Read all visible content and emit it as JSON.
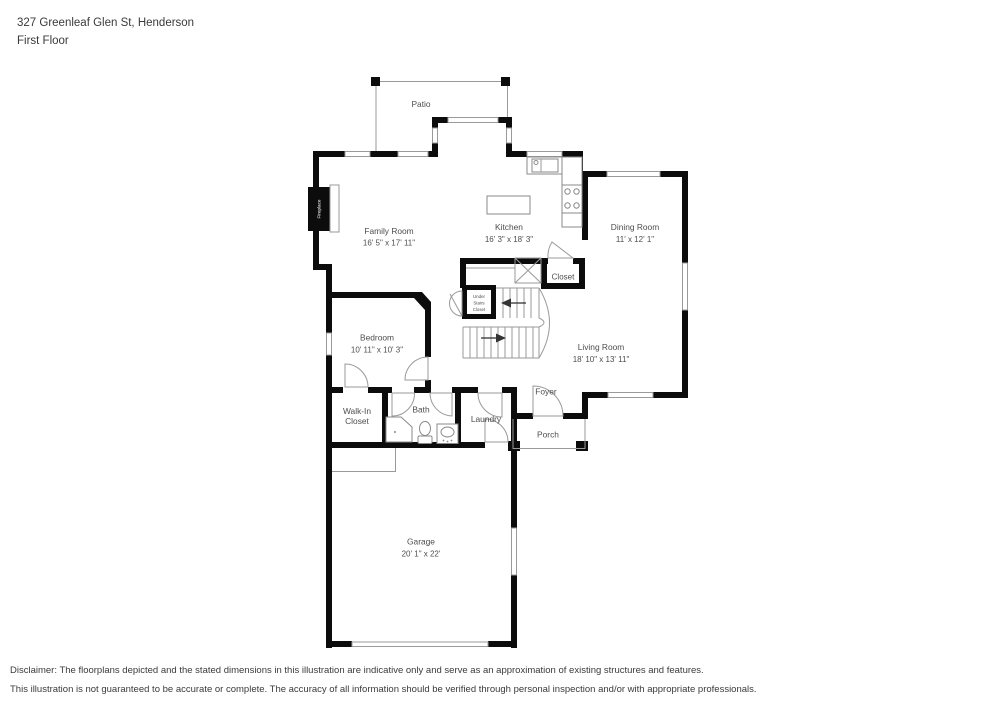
{
  "header": {
    "address": "327 Greenleaf Glen St, Henderson",
    "floor": "First Floor"
  },
  "rooms": {
    "patio": {
      "name": "Patio"
    },
    "family": {
      "name": "Family Room",
      "dims": "16' 5\" x 17' 11\""
    },
    "kitchen": {
      "name": "Kitchen",
      "dims": "16' 3\" x 18' 3\""
    },
    "dining": {
      "name": "Dining Room",
      "dims": "11' x 12' 1\""
    },
    "closet": {
      "name": "Closet"
    },
    "under_stairs": {
      "line1": "Under",
      "line2": "Stairs",
      "line3": "Closet"
    },
    "bedroom": {
      "name": "Bedroom",
      "dims": "10' 11\" x 10' 3\""
    },
    "living": {
      "name": "Living Room",
      "dims": "18' 10\" x 13' 11\""
    },
    "foyer": {
      "name": "Foyer"
    },
    "walkin": {
      "line1": "Walk-In",
      "line2": "Closet"
    },
    "bath": {
      "name": "Bath"
    },
    "laundry": {
      "name": "Laundry"
    },
    "porch": {
      "name": "Porch"
    },
    "garage": {
      "name": "Garage",
      "dims": "20' 1\" x 22'"
    },
    "fireplace": {
      "name": "Fireplace"
    }
  },
  "disclaimer": {
    "line1": "Disclaimer: The floorplans depicted and the stated dimensions in this illustration are indicative only and serve as an approximation of existing structures and features.",
    "line2": "This illustration is not guaranteed to be accurate or complete. The accuracy of all information should be verified through personal inspection and/or with appropriate professionals."
  },
  "colors": {
    "wall": "#0c0c0c",
    "thin_line": "#9a9a9a",
    "label": "#4d4d4d",
    "background": "#ffffff"
  }
}
